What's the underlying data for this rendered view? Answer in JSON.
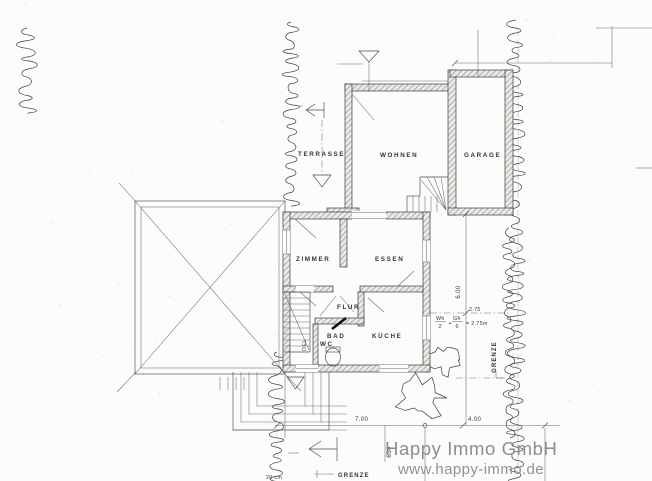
{
  "plan": {
    "rooms": {
      "terrasse": "TERRASSE",
      "wohnen": "WOHNEN",
      "garage": "GARAGE",
      "zimmer": "ZIMMER",
      "essen": "ESSEN",
      "flur": "FLUR",
      "bad": "BAD",
      "wc": "WC",
      "kueche": "KÜCHE",
      "oel": "OEL"
    },
    "dims": {
      "house_width": "7.00",
      "east_setback": "4.00",
      "house_depth": "6.00",
      "setback_line": "2.75",
      "entry_width": "650",
      "formula": {
        "num1": "Wh",
        "den1": "2",
        "plus": "+",
        "num2": "Gh",
        "den2": "6",
        "result": "= 2.75m"
      }
    },
    "boundary": {
      "grenze_east": "GRENZE",
      "grenze_south": "GRENZE",
      "tree_note": "20 cm"
    },
    "watermark": {
      "company": "Happy Immo GmbH",
      "website": "www.happy-immo.de"
    },
    "colors": {
      "paper": "#fcfcfa",
      "ink": "#2e2e2e",
      "wall_hatch": "#9a9a9a",
      "watermark": "#8d8d8d"
    }
  }
}
